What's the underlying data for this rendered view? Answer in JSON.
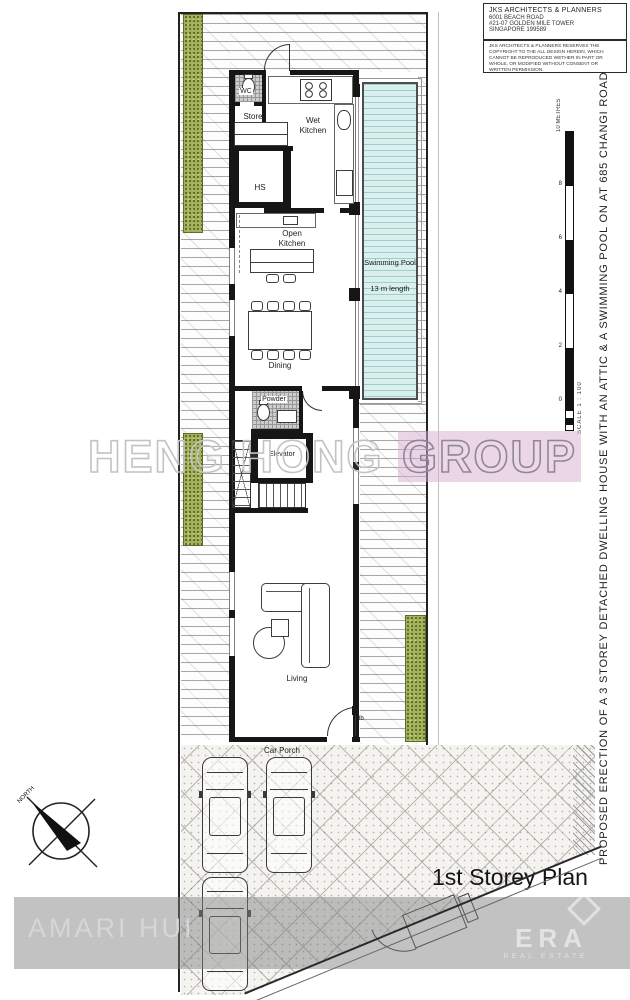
{
  "document": {
    "plan_label": "1st Storey Plan",
    "project_title": "PROPOSED ERECTION OF A 3 STOREY DETACHED DWELLING HOUSE WITH AN ATTIC & A SWIMMING POOL ON AT 685 CHANGI ROAD"
  },
  "title_block": {
    "firm": "JKS ARCHITECTS & PLANNERS",
    "address_line1": "6001 BEACH ROAD",
    "address_line2": "#21-07 GOLDEN MILE TOWER",
    "address_line3": "SINGAPORE 199589",
    "copyright_note": "JKS ARCHITECTS & PLANNERS RESERVES THE COPYRIGHT TO THE ALL DESIGN HEREIN, WHICH CANNOT BE REPRODUCED WETHER IN PART OR WHOLE, OR MODIFIED WITHOUT CONSENT OR WRITTEN PERMISSION."
  },
  "scale_bar": {
    "unit_label": "10 METRES",
    "ticks": [
      "8",
      "6",
      "4",
      "2",
      "0"
    ],
    "scale_label": "SCALE 1 : 100"
  },
  "compass": {
    "label": "NORTH"
  },
  "rooms": {
    "wc": "WC",
    "store": "Store",
    "wet_kitchen": "Wet Kitchen",
    "hs": "HS",
    "open_kitchen": "Open Kitchen",
    "dining": "Dining",
    "swimming_pool": "Swimming Pool",
    "pool_length": "13 m length",
    "powder": "Powder",
    "elevator": "Elevator",
    "living": "Living",
    "car_porch": "Car Porch",
    "db_label": "db"
  },
  "watermarks": {
    "heng_hong": "HENG HONG",
    "group": "GROUP",
    "amari": "AMARI HUI",
    "era": "ERA",
    "era_subtitle": "REAL ESTATE"
  },
  "colors": {
    "pool_fill": "#d9f0ee",
    "planting_green": "#a3b159",
    "group_highlight": "#d5add0",
    "watermark_gray": "#c3c3c3",
    "band_gray": "#808080",
    "wall_black": "#161616"
  }
}
